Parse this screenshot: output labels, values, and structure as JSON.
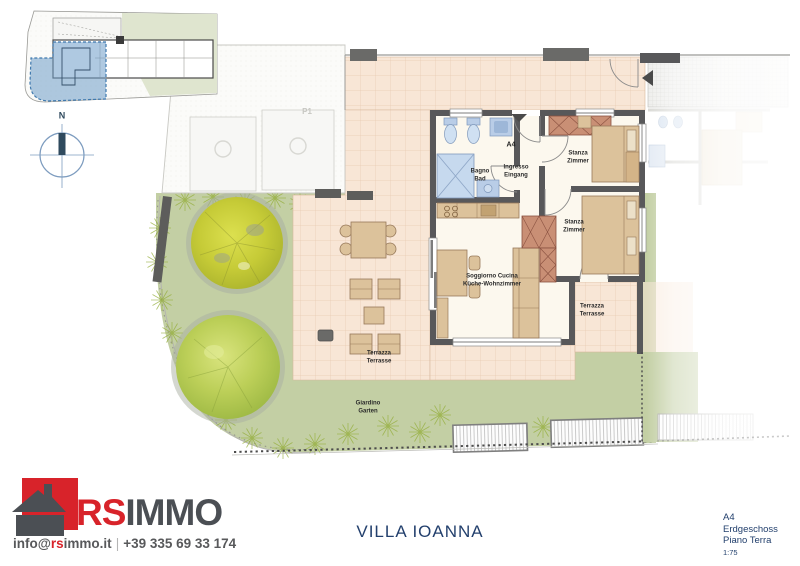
{
  "compass": {
    "north_label": "N"
  },
  "plan": {
    "unit_label": "A4",
    "parking_label": "P1",
    "rooms": {
      "bathroom": "Bagno\nBad",
      "entrance": "Ingresso\nEingang",
      "bedroom1": "Stanza\nZimmer",
      "bedroom2": "Stanza\nZimmer",
      "living": "Soggiorno Cucina\nKüche-Wohnzimmer",
      "terrace_main": "Terrazza\nTerrasse",
      "terrace_right": "Terrazza\nTerrasse",
      "garden": "Giardino\nGarten"
    }
  },
  "footer": {
    "logo": {
      "part1": "RS",
      "part2": "IMMO",
      "email_prefix": "info@",
      "email_highlight": "rs",
      "email_suffix": "immo.it",
      "separator": "|",
      "phone": "+39 335 69 33 174"
    },
    "title": "VILLA IOANNA",
    "info": {
      "unit": "A4",
      "floor_de": "Erdgeschoss",
      "floor_it": "Piano Terra",
      "scale": "1:75"
    }
  },
  "colors": {
    "logo_red": "#d8232a",
    "logo_gray": "#4b4f54",
    "title_navy": "#23406d",
    "garden_green": "#c3cfa4",
    "terrace_tile": "#f8e6d6",
    "wall_gray": "#58585a",
    "highlight_blue": "#6d9cc9",
    "fixture_blue": "#b9cde7",
    "wood_tan": "#dcc29b",
    "wardrobe_red": "#c98f75"
  }
}
